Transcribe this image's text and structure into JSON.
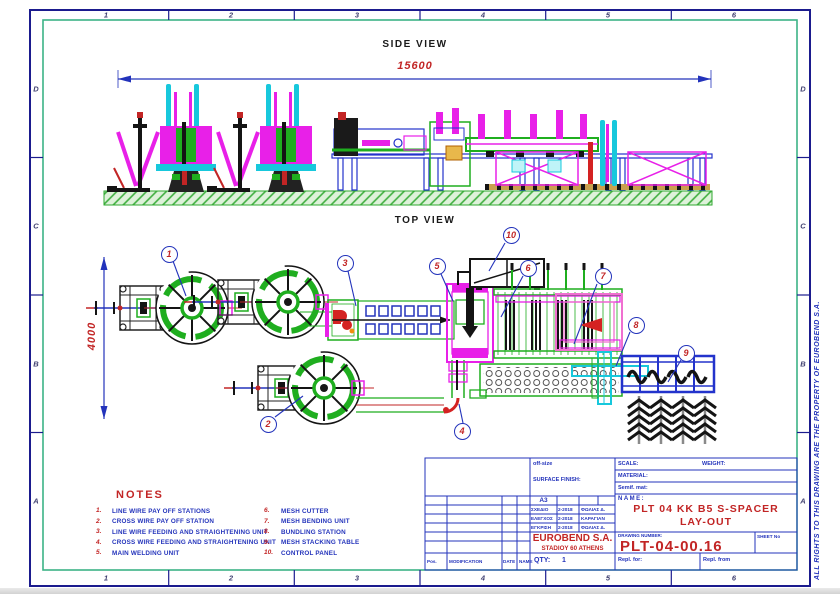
{
  "border": {
    "columns": [
      "1",
      "2",
      "3",
      "4",
      "5",
      "6"
    ],
    "rows": [
      "D",
      "C",
      "B",
      "A"
    ],
    "copyright": "ALL RIGHTS TO THIS DRAWING ARE THE PROPERTY OF  EUROBEND S.A."
  },
  "drawing": {
    "side_view_label": "SIDE VIEW",
    "side_view_dimension": "15600",
    "top_view_label": "TOP VIEW",
    "top_view_dimension": "4000",
    "balloons": [
      "1",
      "2",
      "3",
      "4",
      "5",
      "6",
      "7",
      "8",
      "9",
      "10"
    ]
  },
  "notes": {
    "title": "NOTES",
    "left": [
      {
        "num": "1.",
        "text": "LINE WIRE PAY OFF STATIONS"
      },
      {
        "num": "2.",
        "text": "CROSS WIRE PAY OFF STATION"
      },
      {
        "num": "3.",
        "text": "LINE WIRE FEEDING AND STRAIGHTENING UNIT"
      },
      {
        "num": "4.",
        "text": "CROSS WIRE FEEDING AND STRAIGHTENING UNIT"
      },
      {
        "num": "5.",
        "text": "MAIN WELDING UNIT"
      }
    ],
    "right": [
      {
        "num": "6.",
        "text": "MESH CUTTER"
      },
      {
        "num": "7.",
        "text": "MESH BENDING UNIT"
      },
      {
        "num": "8.",
        "text": "BUNDLING STATION"
      },
      {
        "num": "9.",
        "text": "MESH STACKING TABLE"
      },
      {
        "num": "10.",
        "text": "CONTROL PANEL"
      }
    ]
  },
  "title_block": {
    "off_size": "off-size",
    "surface_finish": "SURFACE FINISH:",
    "scale": "SCALE:",
    "weight": "WEIGHT:",
    "material": "MATERIAL:",
    "semif_mat": "Semif. mat:",
    "format": "A3",
    "sign_rows": [
      {
        "label": "ΣΧΕΔΙΟ",
        "date": "2-2018",
        "name": "ΦΩΛΙΑΣ Δ."
      },
      {
        "label": "ΕΛΕΓΧΟΣ",
        "date": "2-2018",
        "name": "ΚΑΡΑΓΙΑΝ"
      },
      {
        "label": "ΕΓΚΡΙΣΗ",
        "date": "2-2018",
        "name": "ΦΩΛΙΑΣ Δ."
      }
    ],
    "company": "EUROBEND S.A.",
    "address": "STADIOY 60 ATHENS",
    "qty_label": "QTY:",
    "qty_value": "1",
    "name_label": "NAME:",
    "name_line1": "PLT 04 KK B5 S-SPACER",
    "name_line2": "LAY-OUT",
    "drawing_number_label": "DRAWING NUMBER:",
    "drawing_number": "PLT-04-00.16",
    "sheet_no": "SHEET No",
    "repl_for": "Repl. for:",
    "repl_from": "Repl. from",
    "rev_headers": [
      "Pos.",
      "MODIFICATION",
      "DATE",
      "NAME"
    ]
  },
  "colors": {
    "border_navy": "#1b1b8e",
    "frame_green": "#3cb386",
    "line_blue": "#2333bb",
    "text_red": "#c22525",
    "magenta": "#e820e8",
    "cyan": "#17c8dc",
    "draw_green": "#1fae1f"
  }
}
